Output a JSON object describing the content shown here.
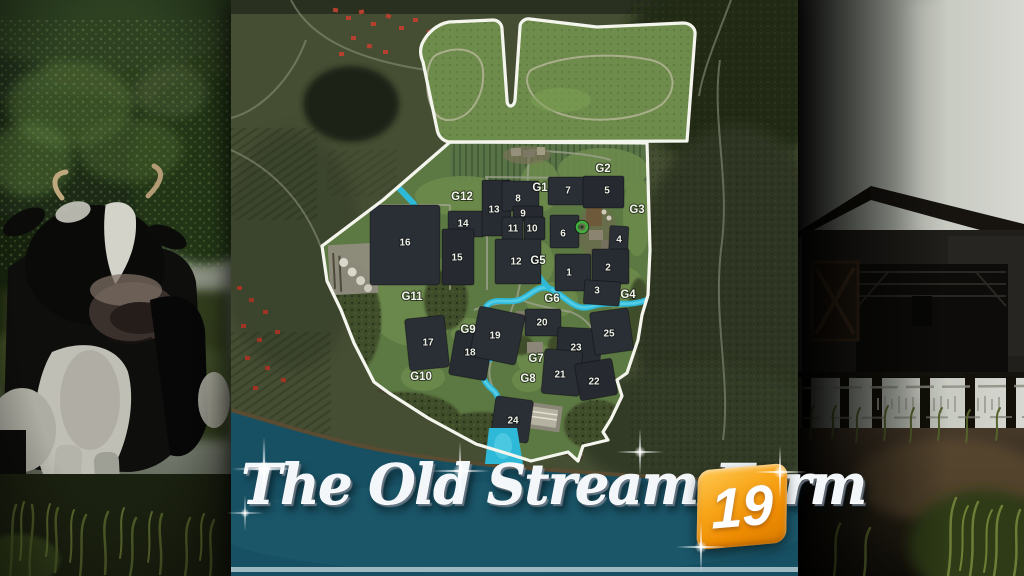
{
  "card": {
    "title": "The Old Stream Farm",
    "logo_badge": "19"
  },
  "map": {
    "field_labels": [
      "1",
      "2",
      "3",
      "4",
      "5",
      "6",
      "7",
      "8",
      "9",
      "10",
      "11",
      "12",
      "13",
      "14",
      "15",
      "16",
      "17",
      "18",
      "19",
      "20",
      "21",
      "22",
      "23",
      "24",
      "25"
    ],
    "grass_labels": [
      "G1",
      "G2",
      "G3",
      "G4",
      "G5",
      "G6",
      "G7",
      "G8",
      "G9",
      "G10",
      "G11",
      "G12"
    ]
  },
  "colors": {
    "boundary_white": "#f4f6ee",
    "field_dark": "#2a2e35",
    "grass_green": "#5d7943",
    "pasture_green": "#6e8c4b",
    "stream_cyan": "#2fb9d8",
    "sea_teal": "#175063",
    "logo_orange": "#f7a315"
  }
}
